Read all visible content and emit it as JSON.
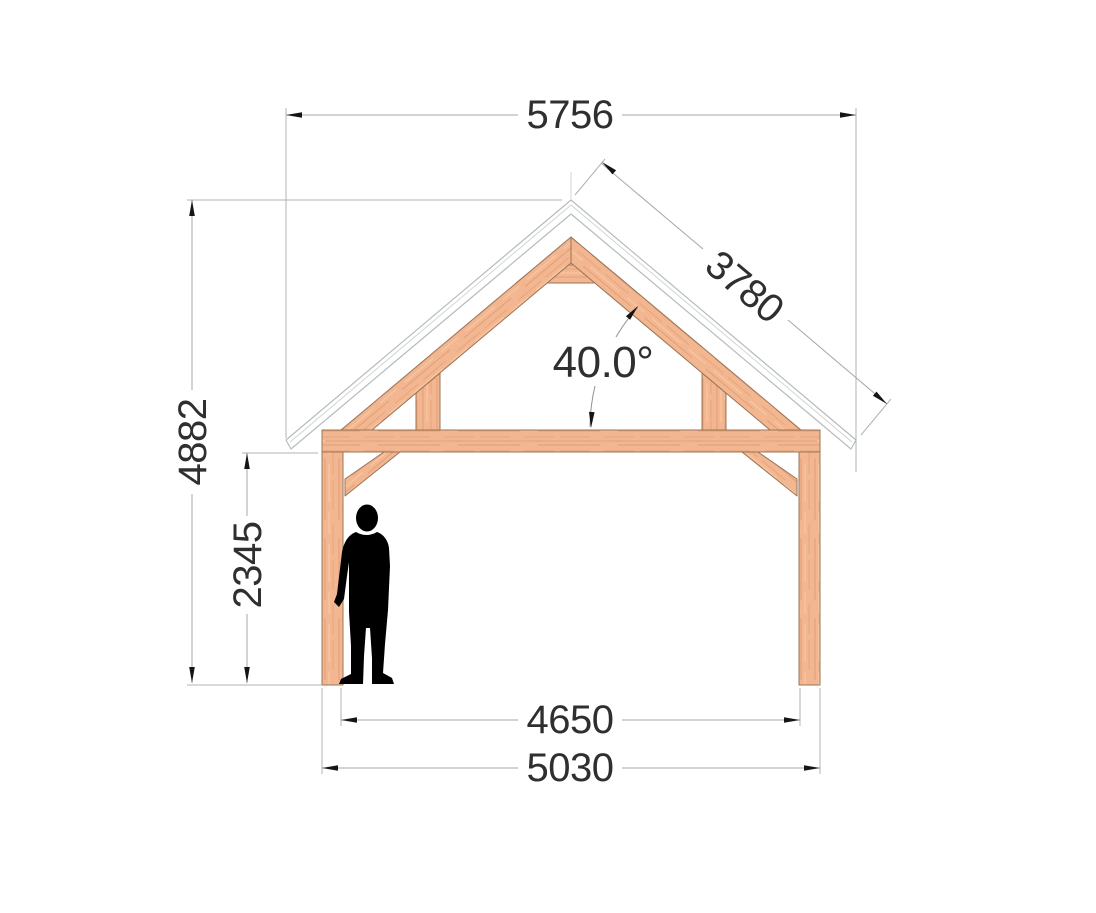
{
  "drawing": {
    "title": "timber-frame-front-elevation",
    "dimensions": {
      "roof_width": "5756",
      "roof_slope_length": "3780",
      "roof_angle": "40.0°",
      "total_height": "4882",
      "clear_height": "2345",
      "inner_span": "4650",
      "outer_span": "5030"
    },
    "colors": {
      "wood": "#f2b690",
      "wood_edge": "#9b7457",
      "dim_line": "#a4a7a9",
      "dim_text": "#2f2f2f",
      "arrow": "#151515",
      "roof_outline": "#b6bbbd",
      "silhouette": "#000000"
    }
  }
}
